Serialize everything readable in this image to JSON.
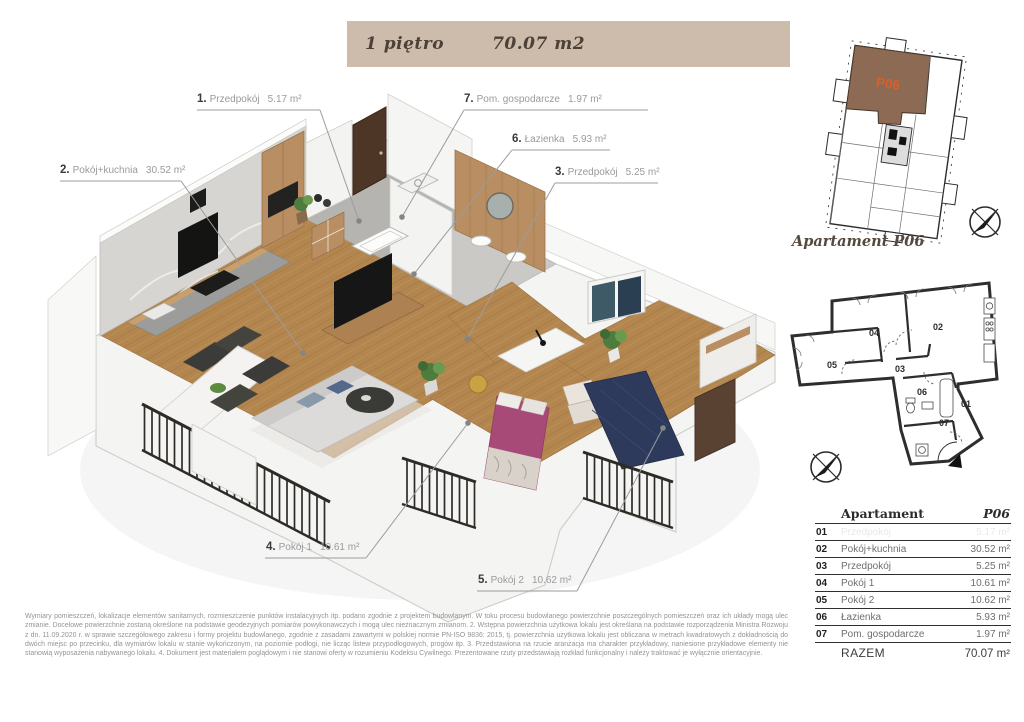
{
  "header": {
    "floor_label": "1 piętro",
    "area_label": "70.07 m2"
  },
  "building_plan": {
    "unit_label": "P06",
    "caption": "Apartament P06"
  },
  "colors": {
    "header_bar": "#cdbcab",
    "unit_highlight": "#8d6a53",
    "unit_label": "#d95f2b",
    "wood_floor": "#b3854f",
    "bed_room1": "#a84a78",
    "bed_room2": "#2e3a5c"
  },
  "plan3d": {
    "labels": [
      {
        "num": "1.",
        "name": "Przedpokój",
        "area": "5.17 m²"
      },
      {
        "num": "2.",
        "name": "Pokój+kuchnia",
        "area": "30.52 m²"
      },
      {
        "num": "3.",
        "name": "Przedpokój",
        "area": "5.25 m²"
      },
      {
        "num": "4.",
        "name": "Pokój 1",
        "area": "10.61 m²"
      },
      {
        "num": "5.",
        "name": "Pokój 2",
        "area": "10.62 m²"
      },
      {
        "num": "6.",
        "name": "Łazienka",
        "area": "5.93 m²"
      },
      {
        "num": "7.",
        "name": "Pom. gospodarcze",
        "area": "1.97 m²"
      }
    ]
  },
  "schematic": {
    "rooms": [
      "01",
      "02",
      "03",
      "04",
      "05",
      "06",
      "07"
    ]
  },
  "table": {
    "title": "Apartament",
    "unit": "P06",
    "rows": [
      {
        "no": "01",
        "name": "Przedpokój",
        "area": "5.17 m²",
        "faded": true
      },
      {
        "no": "02",
        "name": "Pokój+kuchnia",
        "area": "30.52 m²",
        "faded": false
      },
      {
        "no": "03",
        "name": "Przedpokój",
        "area": "5.25 m²",
        "faded": false
      },
      {
        "no": "04",
        "name": "Pokój 1",
        "area": "10.61 m²",
        "faded": false
      },
      {
        "no": "05",
        "name": "Pokój 2",
        "area": "10.62 m²",
        "faded": false
      },
      {
        "no": "06",
        "name": "Łazienka",
        "area": "5.93 m²",
        "faded": false
      },
      {
        "no": "07",
        "name": "Pom. gospodarcze",
        "area": "1.97 m²",
        "faded": false
      }
    ],
    "total_label": "RAZEM",
    "total_area": "70.07 m²"
  },
  "disclaimer": "Wymiary pomieszczeń, lokalizacje elementów sanitarnych, rozmieszczenie punktów instalacyjnych itp. podano zgodnie z projektem budowlanym. W toku procesu budowlanego powierzchnie poszczególnych pomieszczeń oraz ich układy mogą ulec zmianie. Docelowe powierzchnie zostaną określone na podstawie geodezyjnych pomiarów powykonawczych i mogą ulec nieznacznym zmianom. 2. Wstępna powierzchnia użytkowa lokalu jest określana na podstawie rozporządzenia Ministra Rozwoju z dn. 11.09.2020 r. w sprawie szczegółowego zakresu i formy projektu budowlanego, zgodnie z zasadami zawartymi w polskiej normie PN-ISO 9836: 2015, tj. powierzchnia użytkowa lokalu jest obliczana w metrach kwadratowych z dokładnością do dwóch miejsc po przecinku, dla wymiarów lokalu w stanie wykończonym, na poziomie podłogi, nie licząc listew przypodłogowych, progów itp. 3. Przedstawiona na rzucie aranżacja ma charakter przykładowy, naniesione przykładowe elementy nie stanowią wyposażenia nabywanego lokalu. 4. Dokument jest materiałem poglądowym i nie stanowi oferty w rozumieniu Kodeksu Cywilnego. Prezentowane rzuty przedstawiają rozkład funkcjonalny i należy traktować je wyłącznie orientacyjnie."
}
